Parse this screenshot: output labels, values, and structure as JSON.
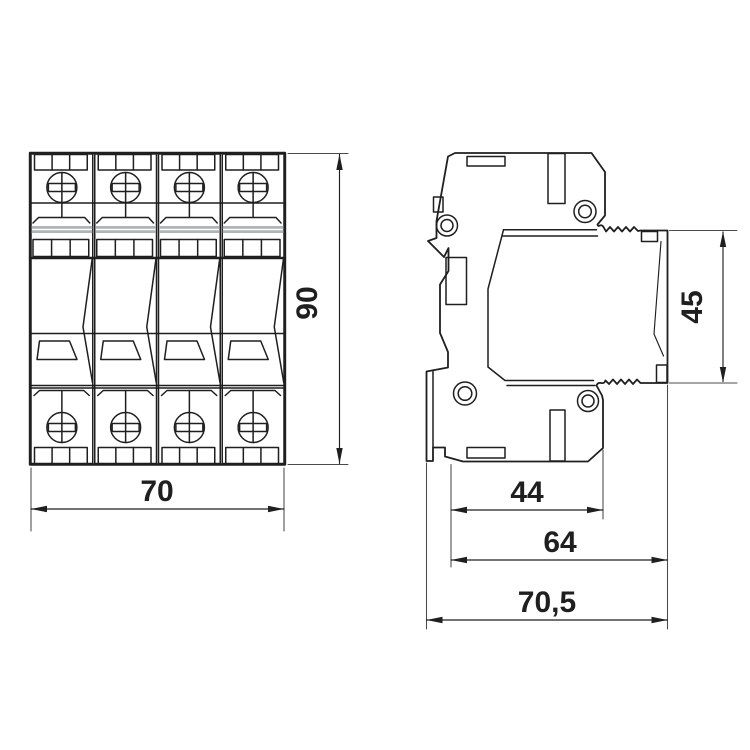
{
  "drawing": {
    "type": "technical-dimension-drawing",
    "background": "#ffffff",
    "line_color": "#1f1f1f",
    "shade_color": "#b2b5b7",
    "front_view": {
      "name": "front view of 4-module DIN-rail surge device",
      "module_count": 4,
      "dim_width": {
        "label": "70",
        "orientation": "horizontal"
      },
      "dim_height": {
        "label": "90",
        "orientation": "vertical"
      }
    },
    "side_view": {
      "name": "side view with pluggable module",
      "dim_module_height": {
        "label": "45",
        "orientation": "vertical"
      },
      "dim_depth_body": {
        "label": "44",
        "orientation": "horizontal"
      },
      "dim_depth_with_module": {
        "label": "64",
        "orientation": "horizontal"
      },
      "dim_depth_total": {
        "label": "70,5",
        "orientation": "horizontal"
      }
    }
  }
}
